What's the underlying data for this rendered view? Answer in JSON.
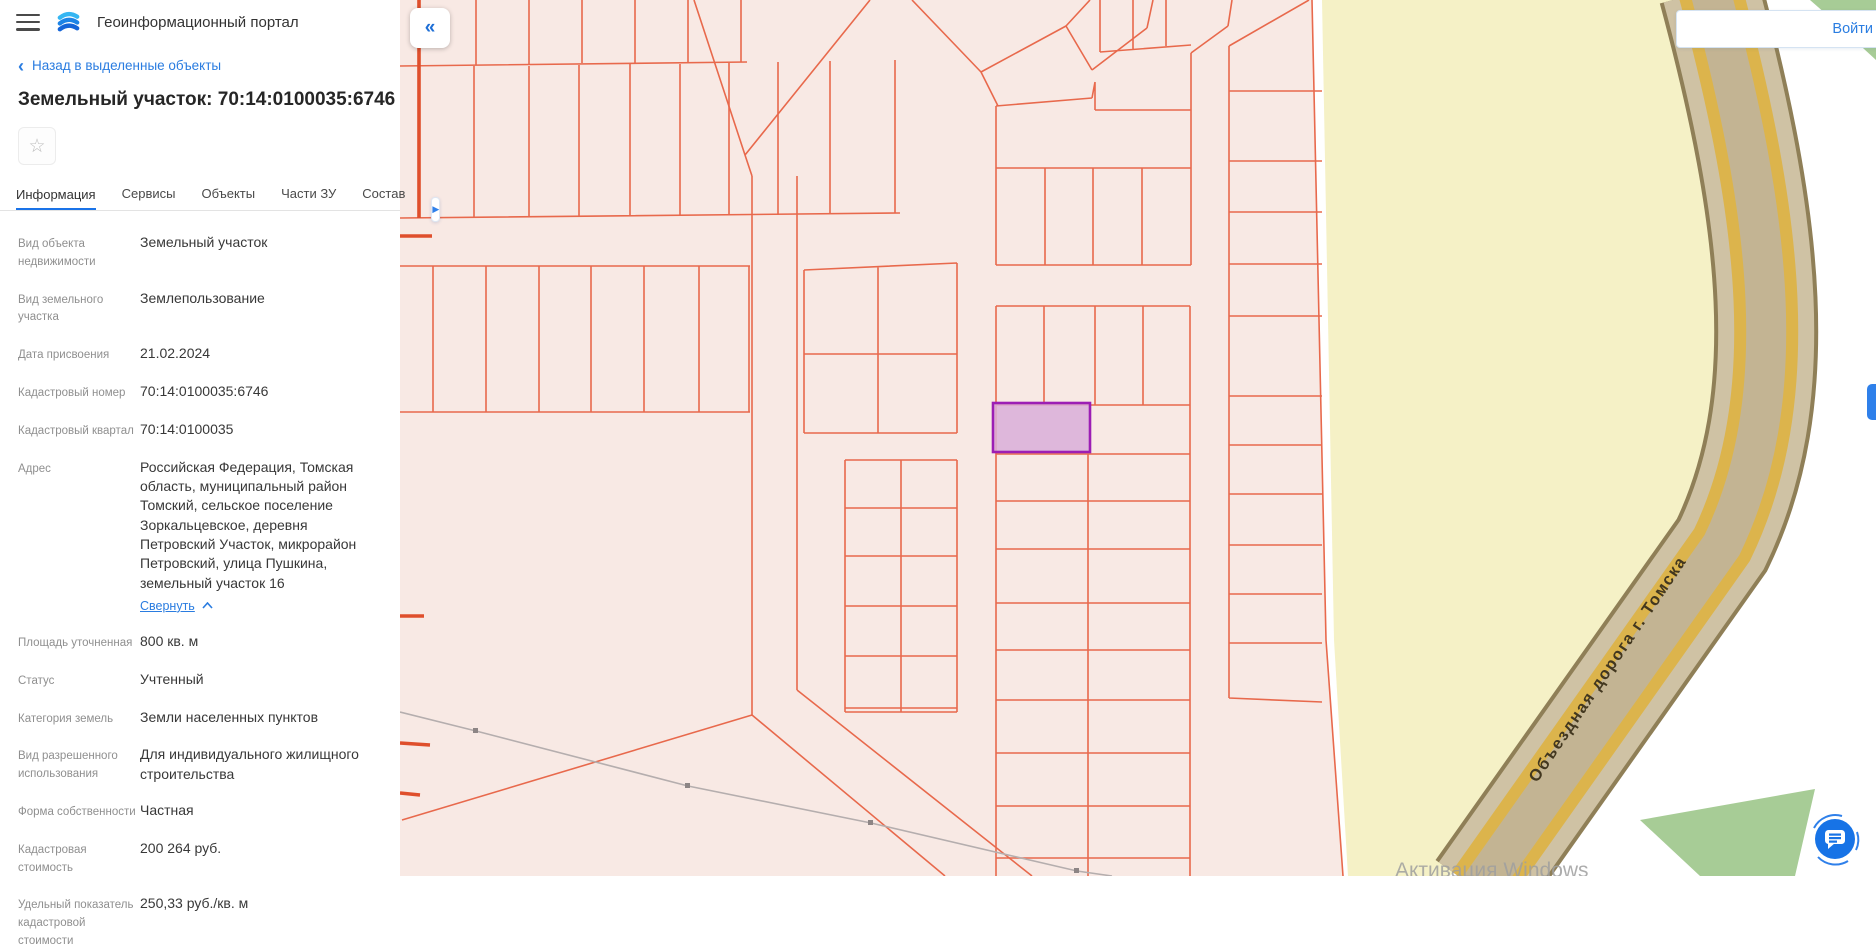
{
  "app": {
    "title": "Геоинформационный портал"
  },
  "panel": {
    "back_label": "Назад в выделенные объекты",
    "title": "Земельный участок: 70:14:0100035:6746",
    "tabs": [
      {
        "label": "Информация",
        "active": true
      },
      {
        "label": "Сервисы",
        "active": false
      },
      {
        "label": "Объекты",
        "active": false
      },
      {
        "label": "Части ЗУ",
        "active": false
      },
      {
        "label": "Состав",
        "active": false
      }
    ],
    "fields": [
      {
        "label": "Вид объекта недвижимости",
        "value": "Земельный участок"
      },
      {
        "label": "Вид земельного участка",
        "value": "Землепользование"
      },
      {
        "label": "Дата присвоения",
        "value": "21.02.2024"
      },
      {
        "label": "Кадастровый номер",
        "value": "70:14:0100035:6746"
      },
      {
        "label": "Кадастровый квартал",
        "value": "70:14:0100035"
      },
      {
        "label": "Адрес",
        "value": "Российская Федерация, Томская область, муниципальный район Томский, сельское поселение Зоркальцевское, деревня Петровский Участок, микрорайон Петровский, улица Пушкина, земельный участок 16"
      },
      {
        "label": "Площадь уточненная",
        "value": "800 кв. м"
      },
      {
        "label": "Статус",
        "value": "Учтенный"
      },
      {
        "label": "Категория земель",
        "value": "Земли населенных пунктов"
      },
      {
        "label": "Вид разрешенного использования",
        "value": "Для индивидуального жилищного строительства"
      },
      {
        "label": "Форма собственности",
        "value": "Частная"
      },
      {
        "label": "Кадастровая стоимость",
        "value": "200 264 руб."
      },
      {
        "label": "Удельный показатель кадастровой стоимости",
        "value": "250,33 руб./кв. м"
      }
    ],
    "address_collapse_label": "Свернуть"
  },
  "icons": {
    "back_chevron": "‹",
    "panel_collapse": "«",
    "tab_more": "▶",
    "star": "☆"
  },
  "map": {
    "login_label": "Войти",
    "road_label": "Объездная дорога г. Томска",
    "watermark": "Активация Windows",
    "colors": {
      "parcel_fill": "#f8e9e4",
      "parcel_line": "#e8694c",
      "parcel_line_thick": "#df4f2c",
      "highlight_fill": "#d9aed9",
      "highlight_border": "#9c1eb4",
      "zone_yellow": "#f5f1c6",
      "road_fill": "#cfc2a4",
      "road_stripe": "#dcb44c",
      "road_border": "#8f7f57",
      "green_area": "#a7cc96",
      "accent_blue": "#1a73e8"
    }
  }
}
